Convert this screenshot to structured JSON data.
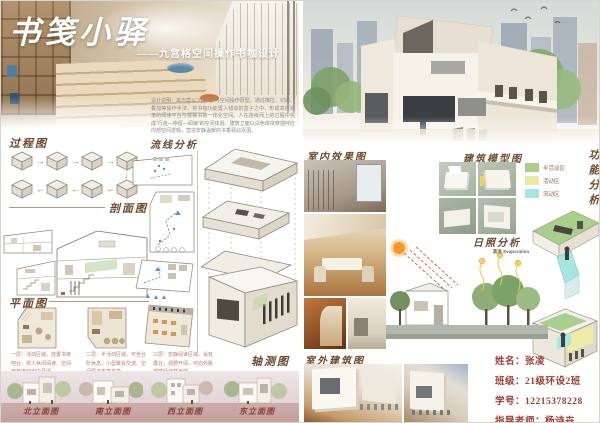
{
  "left": {
    "title": "书笺小驿",
    "subtitle": "——九宫格空间操作书咖设计",
    "description": "设计说明：本方案以“九宫格”为空间操作原型，通过推拉、切削、叠加等操作手法，将书咖功能置入错动的盒子之中，形成高低错落的阅读平台与楼梯书架一体化空间。人在拾级而上的过程中完成“行走—停留—阅读”的空间体验，建筑立面以白色体块穿插呼应内部空间逻辑，营造安静温暖的书香驿站氛围。",
    "labels": {
      "process": "过程图",
      "section": "剖面图",
      "plan": "平面图",
      "circulation": "流线分析",
      "axon": "轴测图"
    },
    "arrows": {
      "right": "→",
      "left": "←",
      "down": "↓"
    },
    "plan_captions": [
      "一层：活动区域，放置书架吧台，供人休闲阅读，空间开放流动自由灵活。",
      "二层：半活动区域，可坐台阶休息，小型聚会交流，空间层次丰富多变。",
      "三层：安静阅读区域，设有露台，视野开阔，可向外眺望感受自然光线。"
    ],
    "elevations": [
      "北立面图",
      "南立面图",
      "西立面图",
      "东立面图"
    ]
  },
  "right": {
    "labels": {
      "interior": "室内效果图",
      "model": "建筑模型图",
      "function_analysis": "功能分析",
      "sunlight": "日照分析",
      "exterior": "室外建筑图"
    },
    "legend": [
      {
        "color": "#a9cf8c",
        "label": "半活动区"
      },
      {
        "color": "#e9e9a6",
        "label": "活动区"
      },
      {
        "color": "#a5e6e2",
        "label": "流动区"
      }
    ],
    "sun": {
      "evaporation": "蒸发 Evaporation"
    },
    "info": [
      "姓名：张凌",
      "班级：21级环设2班",
      "学号：12215378228",
      "指导老师：杨诗卉"
    ]
  },
  "colors": {
    "accent_brown": "#6b4a2e",
    "label_red": "#8a4038",
    "info_red": "#9a3f35"
  }
}
